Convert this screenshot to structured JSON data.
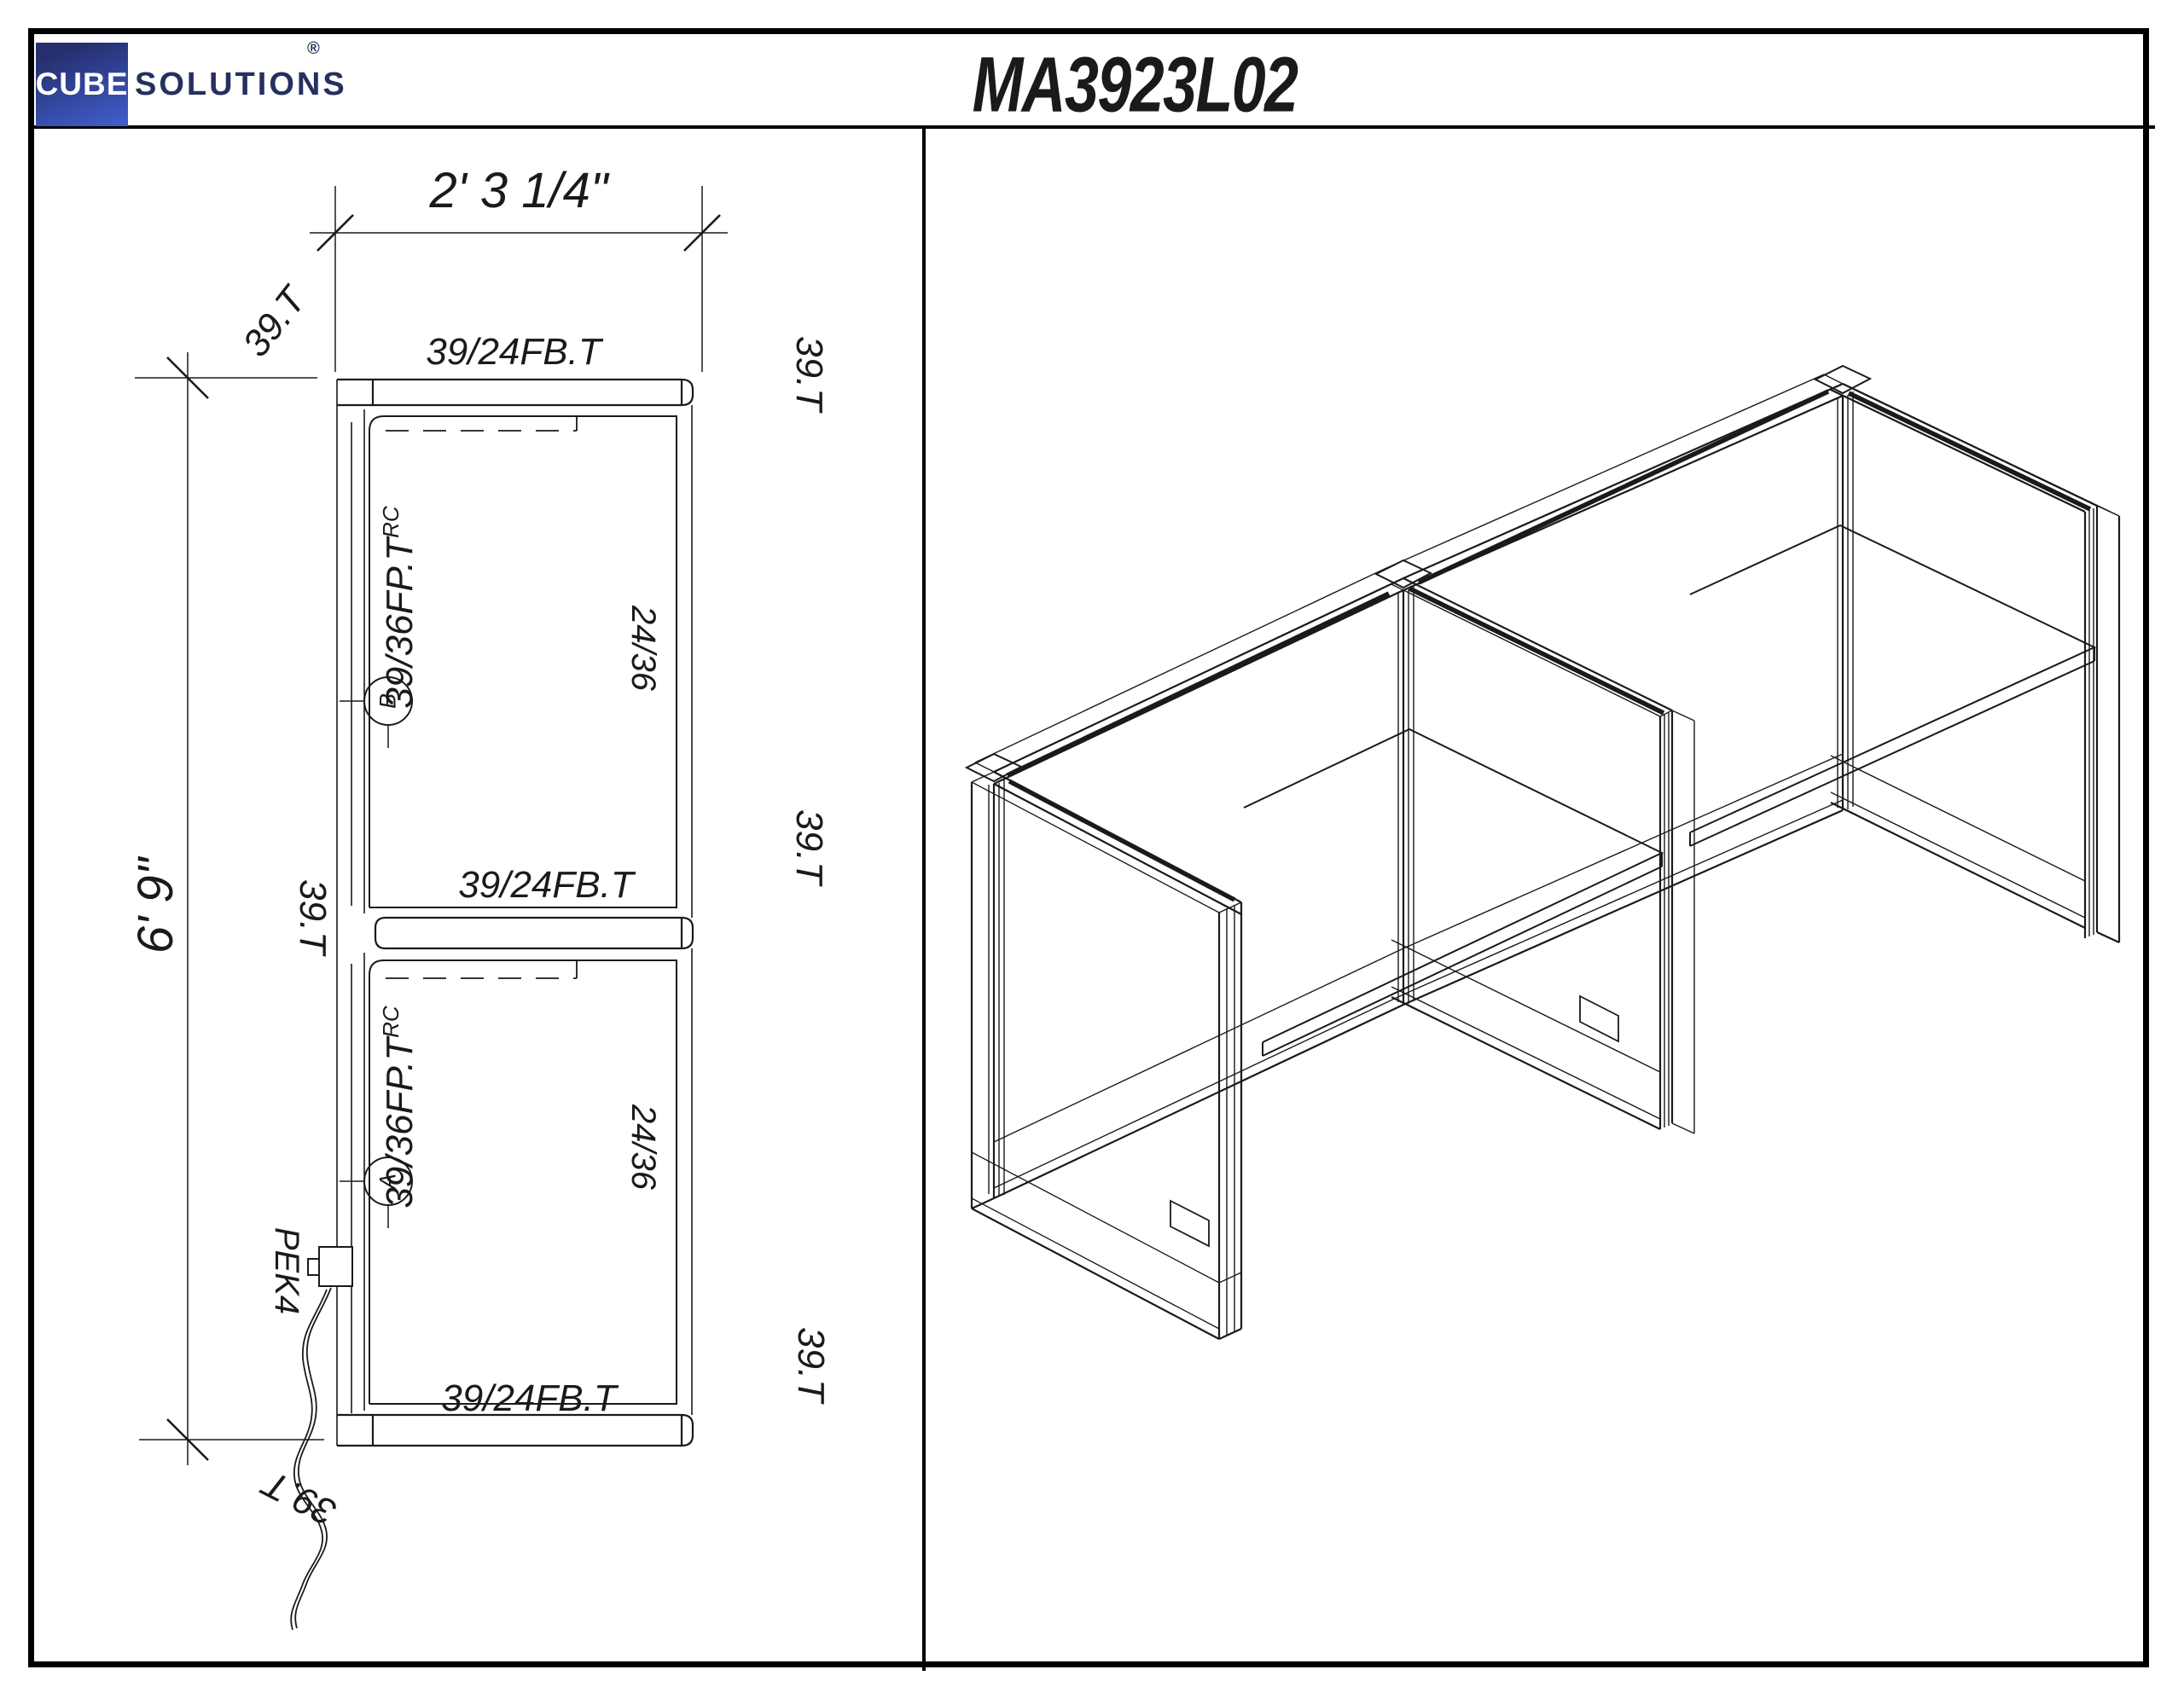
{
  "colors": {
    "line": "#1a1a1a",
    "logo_blue_dark": "#252f6e",
    "logo_blue_light": "#3f5cc8",
    "logo_text_navy": "#25305f",
    "paper": "#ffffff"
  },
  "header": {
    "logo_cube": "CUBE",
    "logo_solutions": "SOLUTIONS",
    "logo_registered": "®",
    "title": "MA3923L02"
  },
  "plan": {
    "dim_width": "2' 3 1/4\"",
    "dim_height": "6' 9\"",
    "panel_fb": "39/24FB.T",
    "panel_fp": "39/36FP.T",
    "panel_fp_sup": "RC",
    "tile_tag": "39.T",
    "surface": "24/36",
    "marker_upper": "B",
    "marker_lower": "A",
    "power_kit": "PEK4"
  }
}
